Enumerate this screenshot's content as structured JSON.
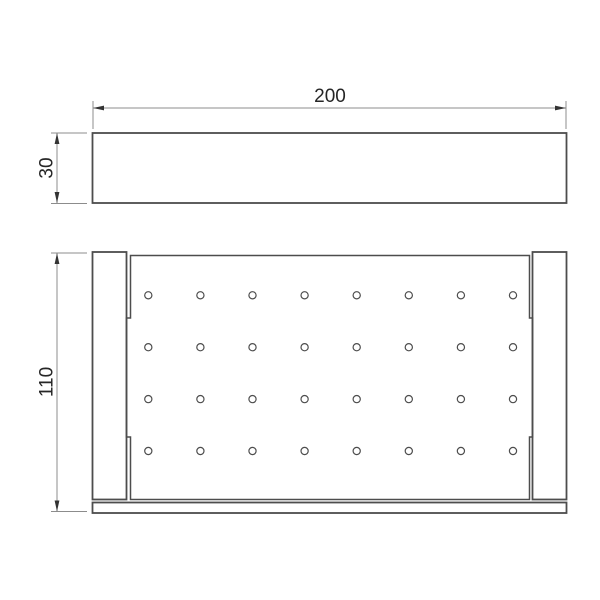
{
  "drawing": {
    "views": {
      "front_view_name": "front-elevation",
      "plan_view_name": "plan-view"
    },
    "dimensions": {
      "width": {
        "label": "200"
      },
      "height": {
        "label": "30"
      },
      "depth": {
        "label": "110"
      }
    },
    "holes": {
      "rows": 4,
      "cols": 8
    }
  },
  "colors": {
    "background": "#ffffff",
    "line": "#4d4d4d",
    "dim_line": "#8c8c8c",
    "arrow": "#333333",
    "text": "#262626"
  }
}
